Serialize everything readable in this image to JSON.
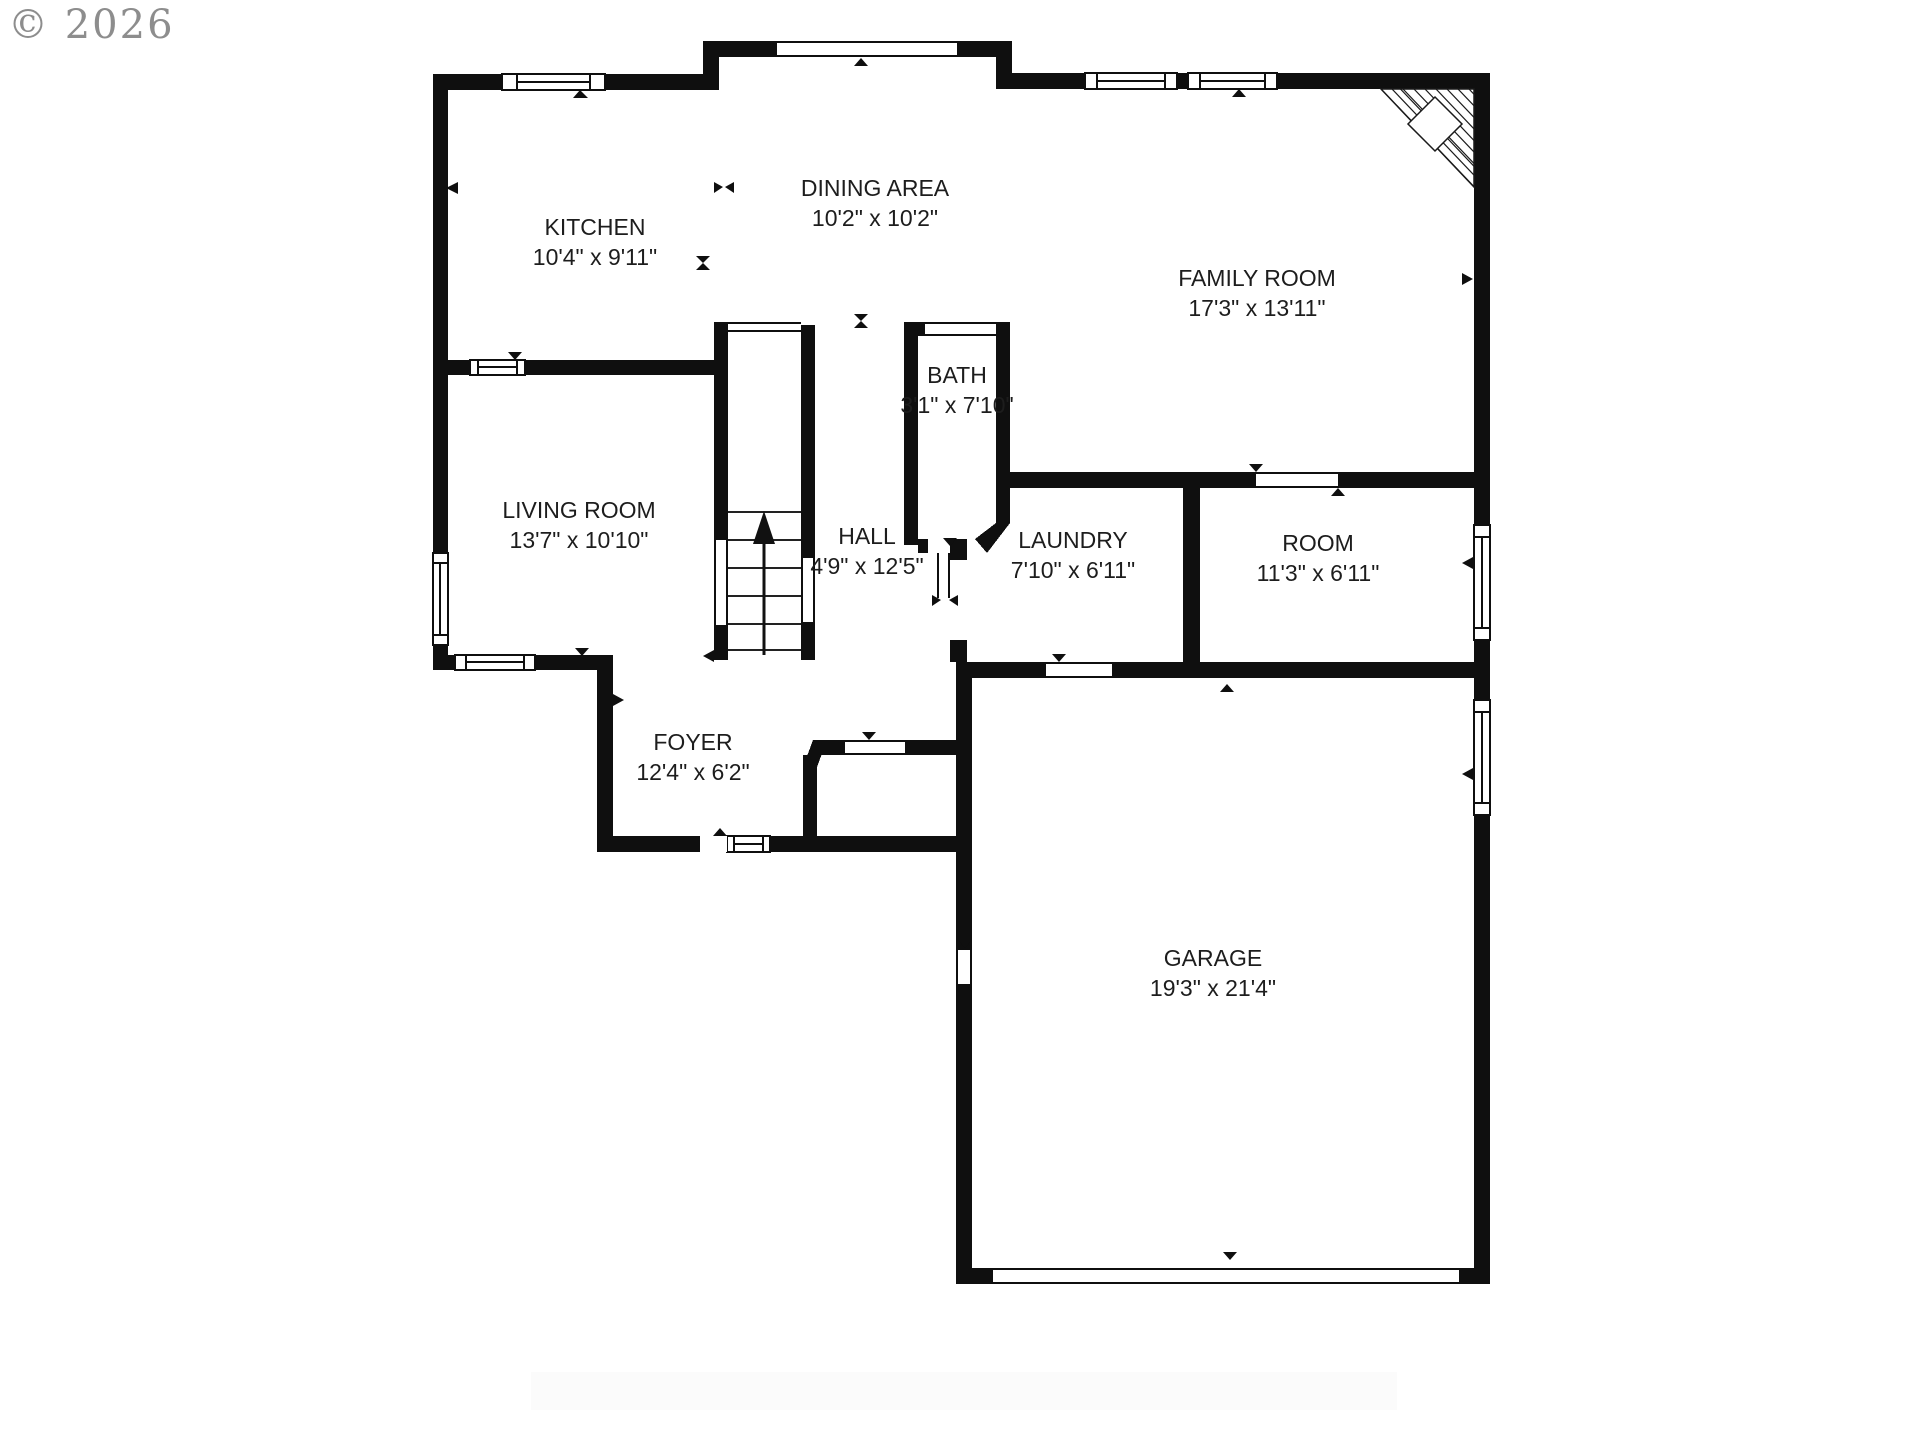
{
  "meta": {
    "watermark": "© 2026",
    "type_label": "first-floor plan"
  },
  "colors": {
    "wall": "#0f0f0f",
    "background": "#ffffff",
    "watermark_gray": "#8d8d8d",
    "label_text": "#1d1d1d"
  },
  "rooms": [
    {
      "name": "KITCHEN",
      "dims": "10'4\" x 9'11\""
    },
    {
      "name": "DINING AREA",
      "dims": "10'2\" x 10'2\""
    },
    {
      "name": "FAMILY ROOM",
      "dims": "17'3\" x 13'11\""
    },
    {
      "name": "BATH",
      "dims": "3'1\" x 7'10\""
    },
    {
      "name": "LIVING ROOM",
      "dims": "13'7\" x 10'10\""
    },
    {
      "name": "HALL",
      "dims": "4'9\" x 12'5\""
    },
    {
      "name": "LAUNDRY",
      "dims": "7'10\" x 6'11\""
    },
    {
      "name": "ROOM",
      "dims": "11'3\" x 6'11\""
    },
    {
      "name": "FOYER",
      "dims": "12'4\" x 6'2\""
    },
    {
      "name": "GARAGE",
      "dims": "19'3\" x 21'4\""
    }
  ],
  "icons": {
    "stairs_up_arrow": "up-arrow",
    "door_marker": "small-triangle",
    "corner_fireplace": "hatched-corner-with-diamond",
    "window": "double-line-window"
  }
}
